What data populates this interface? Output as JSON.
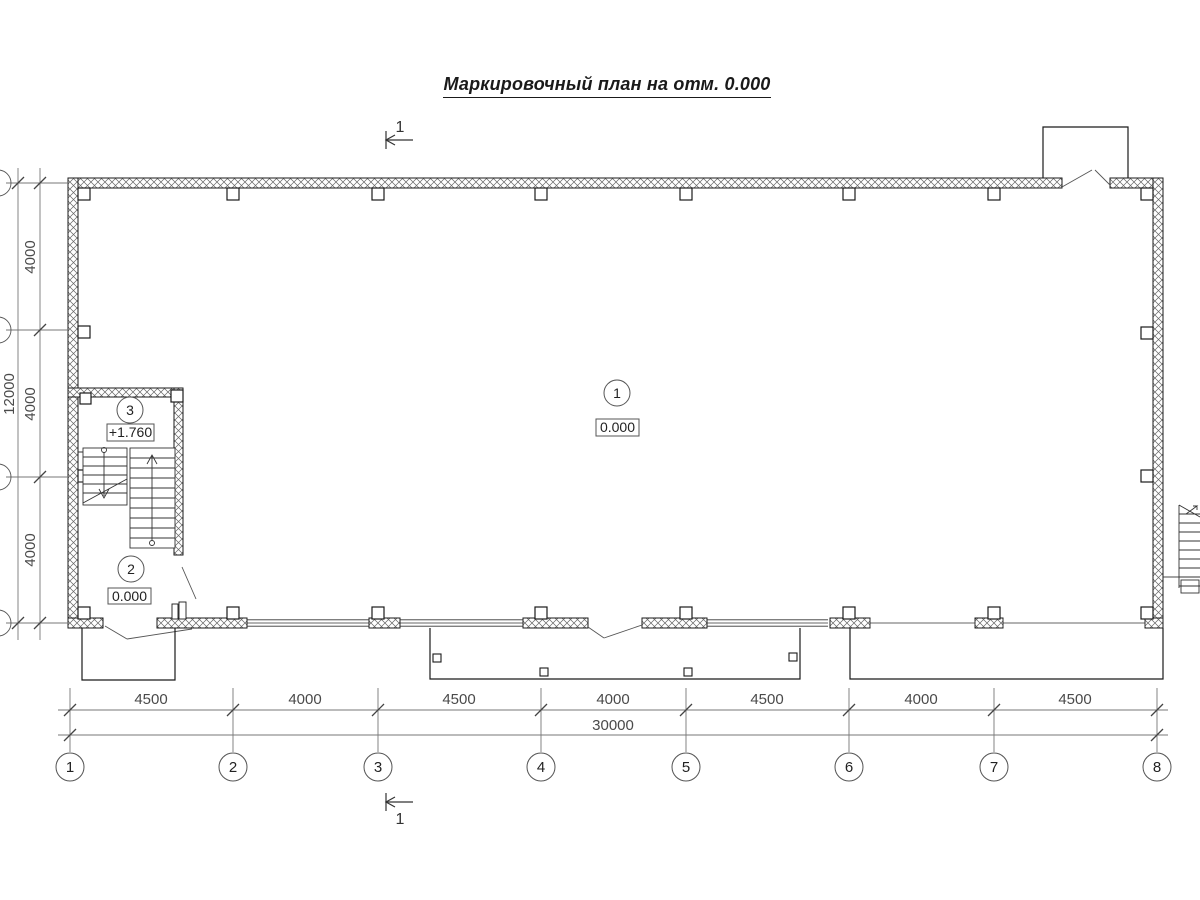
{
  "title": "Маркировочный план на отм. 0.000",
  "section_marks": {
    "top": "1",
    "bottom": "1"
  },
  "rooms": [
    {
      "number": "1",
      "elevation": "0.000"
    },
    {
      "number": "2",
      "elevation": "0.000"
    },
    {
      "number": "3",
      "elevation": "+1.760"
    }
  ],
  "grid": {
    "columns": [
      "1",
      "2",
      "3",
      "4",
      "5",
      "6",
      "7",
      "8"
    ],
    "column_dims": [
      "4500",
      "4000",
      "4500",
      "4000",
      "4500",
      "4000",
      "4500"
    ],
    "total_width": "30000",
    "row_dims": [
      "4000",
      "4000",
      "4000"
    ],
    "total_height": "12000"
  }
}
